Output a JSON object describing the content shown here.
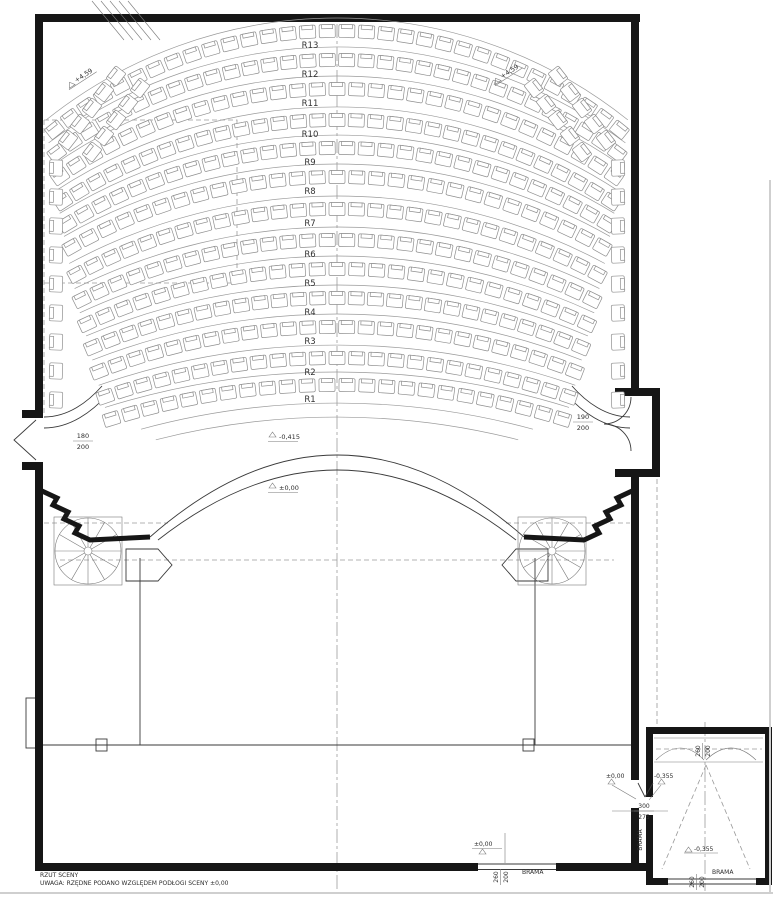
{
  "drawing": {
    "title": "RZUT SCENY",
    "note": "UWAGA: RZĘDNE PODANO WZGLĘDEM PODŁOGI SCENY ±0,00"
  },
  "seating": {
    "row_labels": [
      "R1",
      "R2",
      "R3",
      "R4",
      "R5",
      "R6",
      "R7",
      "R8",
      "R9",
      "R10",
      "R11",
      "R12",
      "R13"
    ]
  },
  "levels": {
    "balcony_left": "+4,59",
    "balcony_right": "+4,59",
    "orchestra_pit": "-0,415",
    "stage_front": "±0,00",
    "stage_rear": "±0,00",
    "passage_floor": "±0,00",
    "passage_lowered": "-0,355",
    "dock_floor": "-0,355"
  },
  "openings": {
    "left_exit_width": "180",
    "left_exit_height": "200",
    "right_exit_width": "190",
    "right_exit_height": "200",
    "passage_width": "300",
    "passage_height": "275",
    "stage_rear_width": "260",
    "stage_rear_height": "200",
    "dock_top_width": "260",
    "dock_top_height": "200",
    "dock_bottom_width": "260",
    "dock_bottom_height": "200",
    "gate_passage": "BRAMA",
    "gate_stage_rear": "BRAMA",
    "gate_dock": "BRAMA"
  },
  "colors": {
    "ink": "#2d2d2d",
    "wall": "#161616",
    "seat_stroke": "#8f8f8f",
    "guide": "#9a9a9a",
    "background": "#ffffff"
  }
}
